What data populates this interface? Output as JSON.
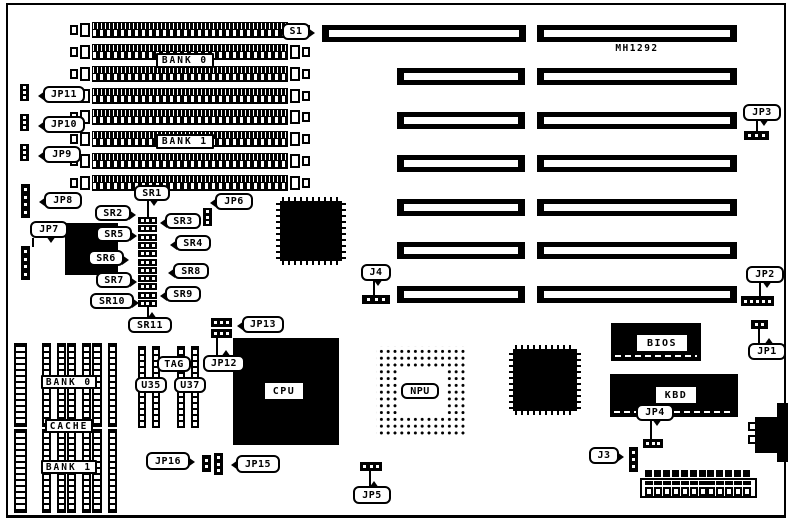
{
  "title": "MH1292",
  "colors": {
    "foreground": "#000000",
    "background": "#ffffff"
  },
  "labels": [
    {
      "id": "s1",
      "text": "S1",
      "x": 282,
      "y": 23,
      "w": 28,
      "h": 17,
      "tail": "r"
    },
    {
      "id": "bank0-top",
      "text": "BANK 0",
      "x": 156,
      "y": 53,
      "w": 58,
      "h": 15,
      "style": "sq"
    },
    {
      "id": "bank1-top",
      "text": "BANK 1",
      "x": 156,
      "y": 134,
      "w": 58,
      "h": 15,
      "style": "sq"
    },
    {
      "id": "jp11",
      "text": "JP11",
      "x": 43,
      "y": 86,
      "w": 42,
      "h": 17,
      "tail": "l"
    },
    {
      "id": "jp10",
      "text": "JP10",
      "x": 43,
      "y": 116,
      "w": 42,
      "h": 17,
      "tail": "l"
    },
    {
      "id": "jp9",
      "text": "JP9",
      "x": 43,
      "y": 146,
      "w": 38,
      "h": 17,
      "tail": "l"
    },
    {
      "id": "jp8",
      "text": "JP8",
      "x": 44,
      "y": 192,
      "w": 38,
      "h": 17,
      "tail": "l"
    },
    {
      "id": "jp7",
      "text": "JP7",
      "x": 30,
      "y": 221,
      "w": 38,
      "h": 17,
      "tail": "d"
    },
    {
      "id": "sr1",
      "text": "SR1",
      "x": 134,
      "y": 185,
      "w": 36,
      "h": 16,
      "tail": "d"
    },
    {
      "id": "sr2",
      "text": "SR2",
      "x": 95,
      "y": 205,
      "w": 36,
      "h": 16,
      "tail": "r"
    },
    {
      "id": "sr3",
      "text": "SR3",
      "x": 165,
      "y": 213,
      "w": 36,
      "h": 16,
      "tail": "l"
    },
    {
      "id": "sr5",
      "text": "SR5",
      "x": 96,
      "y": 226,
      "w": 36,
      "h": 16,
      "tail": "r"
    },
    {
      "id": "sr4",
      "text": "SR4",
      "x": 175,
      "y": 235,
      "w": 36,
      "h": 16,
      "tail": "l"
    },
    {
      "id": "sr6",
      "text": "SR6",
      "x": 88,
      "y": 250,
      "w": 36,
      "h": 16,
      "tail": "r"
    },
    {
      "id": "sr8",
      "text": "SR8",
      "x": 173,
      "y": 263,
      "w": 36,
      "h": 16,
      "tail": "l"
    },
    {
      "id": "sr7",
      "text": "SR7",
      "x": 96,
      "y": 272,
      "w": 36,
      "h": 16,
      "tail": "r"
    },
    {
      "id": "sr9",
      "text": "SR9",
      "x": 165,
      "y": 286,
      "w": 36,
      "h": 16,
      "tail": "l"
    },
    {
      "id": "sr10",
      "text": "SR10",
      "x": 90,
      "y": 293,
      "w": 44,
      "h": 16,
      "tail": "r"
    },
    {
      "id": "sr11",
      "text": "SR11",
      "x": 128,
      "y": 317,
      "w": 44,
      "h": 16,
      "tail": "u"
    },
    {
      "id": "jp6",
      "text": "JP6",
      "x": 215,
      "y": 193,
      "w": 38,
      "h": 17,
      "tail": "l"
    },
    {
      "id": "jp13",
      "text": "JP13",
      "x": 242,
      "y": 316,
      "w": 42,
      "h": 17,
      "tail": "l"
    },
    {
      "id": "jp12",
      "text": "JP12",
      "x": 203,
      "y": 355,
      "w": 42,
      "h": 17,
      "tail": "u"
    },
    {
      "id": "tag",
      "text": "TAG",
      "x": 157,
      "y": 356,
      "w": 34,
      "h": 16
    },
    {
      "id": "u35",
      "text": "U35",
      "x": 135,
      "y": 377,
      "w": 32,
      "h": 16
    },
    {
      "id": "u37",
      "text": "U37",
      "x": 174,
      "y": 377,
      "w": 32,
      "h": 16
    },
    {
      "id": "jp16",
      "text": "JP16",
      "x": 146,
      "y": 452,
      "w": 44,
      "h": 18,
      "tail": "r"
    },
    {
      "id": "jp15",
      "text": "JP15",
      "x": 236,
      "y": 455,
      "w": 44,
      "h": 18,
      "tail": "l"
    },
    {
      "id": "jp5",
      "text": "JP5",
      "x": 353,
      "y": 486,
      "w": 38,
      "h": 18,
      "tail": "u"
    },
    {
      "id": "j4",
      "text": "J4",
      "x": 361,
      "y": 264,
      "w": 30,
      "h": 17,
      "tail": "d"
    },
    {
      "id": "jp3",
      "text": "JP3",
      "x": 743,
      "y": 104,
      "w": 38,
      "h": 17,
      "tail": "d"
    },
    {
      "id": "jp2",
      "text": "JP2",
      "x": 746,
      "y": 266,
      "w": 38,
      "h": 17,
      "tail": "d"
    },
    {
      "id": "jp1",
      "text": "JP1",
      "x": 748,
      "y": 343,
      "w": 38,
      "h": 17,
      "tail": "u"
    },
    {
      "id": "jp4",
      "text": "JP4",
      "x": 636,
      "y": 404,
      "w": 38,
      "h": 17,
      "tail": "d"
    },
    {
      "id": "j3",
      "text": "J3",
      "x": 589,
      "y": 447,
      "w": 30,
      "h": 17,
      "tail": "r"
    },
    {
      "id": "bank0-cache",
      "text": "BANK 0",
      "x": 41,
      "y": 375,
      "w": 56,
      "h": 14,
      "style": "sq"
    },
    {
      "id": "cache",
      "text": "CACHE",
      "x": 45,
      "y": 419,
      "w": 48,
      "h": 14,
      "style": "sq"
    },
    {
      "id": "bank1-cache",
      "text": "BANK 1",
      "x": 41,
      "y": 460,
      "w": 56,
      "h": 14,
      "style": "sq"
    },
    {
      "id": "cpu",
      "text": "CPU",
      "x": 265,
      "y": 383,
      "w": 38,
      "h": 16,
      "style": "plain"
    },
    {
      "id": "npu",
      "text": "NPU",
      "x": 401,
      "y": 383,
      "w": 38,
      "h": 16
    },
    {
      "id": "bios",
      "text": "BIOS",
      "x": 637,
      "y": 335,
      "w": 50,
      "h": 16,
      "style": "plain"
    },
    {
      "id": "kbd",
      "text": "KBD",
      "x": 656,
      "y": 387,
      "w": 40,
      "h": 16,
      "style": "plain"
    },
    {
      "id": "mh1292",
      "text": "MH1292",
      "x": 610,
      "y": 42,
      "w": 54,
      "h": 12,
      "style": "text"
    }
  ],
  "simm_bank_rows_y": [
    22,
    44,
    66,
    88,
    109,
    131,
    153,
    175
  ],
  "isa_slots": [
    {
      "x": 322,
      "y": 25,
      "w": 204
    },
    {
      "x": 537,
      "y": 25,
      "w": 200
    },
    {
      "x": 397,
      "y": 68,
      "w": 128
    },
    {
      "x": 537,
      "y": 68,
      "w": 200
    },
    {
      "x": 397,
      "y": 112,
      "w": 128
    },
    {
      "x": 537,
      "y": 112,
      "w": 200
    },
    {
      "x": 397,
      "y": 155,
      "w": 128
    },
    {
      "x": 537,
      "y": 155,
      "w": 200
    },
    {
      "x": 397,
      "y": 199,
      "w": 128
    },
    {
      "x": 537,
      "y": 199,
      "w": 200
    },
    {
      "x": 397,
      "y": 242,
      "w": 128
    },
    {
      "x": 537,
      "y": 242,
      "w": 200
    },
    {
      "x": 397,
      "y": 286,
      "w": 128
    },
    {
      "x": 537,
      "y": 286,
      "w": 200
    }
  ],
  "chips": [
    {
      "id": "qfp-chipset-1",
      "type": "qfp",
      "x": 276,
      "y": 197,
      "w": 70,
      "h": 68
    },
    {
      "id": "qfp-chipset-2",
      "type": "qfp",
      "x": 509,
      "y": 345,
      "w": 72,
      "h": 70
    },
    {
      "id": "cpu-chip",
      "type": "solid",
      "x": 233,
      "y": 338,
      "w": 106,
      "h": 107
    },
    {
      "id": "plcc-chip",
      "type": "solid",
      "x": 65,
      "y": 223,
      "w": 53,
      "h": 52
    },
    {
      "id": "npu-socket",
      "type": "pga",
      "x": 376,
      "y": 346,
      "w": 90,
      "h": 90,
      "ix": 398,
      "iy": 368,
      "iw": 47,
      "ih": 47
    },
    {
      "id": "bios-chip",
      "type": "chip",
      "x": 611,
      "y": 323,
      "w": 90,
      "h": 38
    },
    {
      "id": "kbd-chip",
      "type": "chip",
      "x": 610,
      "y": 374,
      "w": 128,
      "h": 43
    }
  ],
  "dip_chips": [
    {
      "x": 14,
      "y": 343,
      "w": 13,
      "h": 84,
      "cols": 1
    },
    {
      "x": 42,
      "y": 343,
      "w": 24,
      "h": 84,
      "cols": 2
    },
    {
      "x": 67,
      "y": 343,
      "w": 24,
      "h": 84,
      "cols": 2
    },
    {
      "x": 92,
      "y": 343,
      "w": 25,
      "h": 84,
      "cols": 2
    },
    {
      "x": 14,
      "y": 429,
      "w": 13,
      "h": 84,
      "cols": 1
    },
    {
      "x": 42,
      "y": 429,
      "w": 24,
      "h": 84,
      "cols": 2
    },
    {
      "x": 67,
      "y": 429,
      "w": 24,
      "h": 84,
      "cols": 2
    },
    {
      "x": 92,
      "y": 429,
      "w": 25,
      "h": 84,
      "cols": 2
    },
    {
      "x": 138,
      "y": 346,
      "w": 22,
      "h": 82,
      "cols": 2
    },
    {
      "x": 177,
      "y": 346,
      "w": 22,
      "h": 82,
      "cols": 2
    }
  ],
  "jumpers": [
    {
      "id": "jp11-jumper",
      "x": 20,
      "y": 84,
      "w": 9,
      "h": 17,
      "pins": 3,
      "orient": "v"
    },
    {
      "id": "jp10-jumper",
      "x": 20,
      "y": 114,
      "w": 9,
      "h": 17,
      "pins": 3,
      "orient": "v"
    },
    {
      "id": "jp9-jumper",
      "x": 20,
      "y": 144,
      "w": 9,
      "h": 17,
      "pins": 3,
      "orient": "v"
    },
    {
      "id": "jp8-jumper",
      "x": 21,
      "y": 184,
      "w": 9,
      "h": 34,
      "pins": 4,
      "orient": "v"
    },
    {
      "id": "jp7-jumper",
      "x": 21,
      "y": 246,
      "w": 9,
      "h": 34,
      "pins": 4,
      "orient": "v"
    },
    {
      "id": "jp6-jumper",
      "x": 203,
      "y": 208,
      "w": 9,
      "h": 18,
      "pins": 3,
      "orient": "v"
    },
    {
      "id": "jp13-jumper-a",
      "x": 211,
      "y": 318,
      "w": 21,
      "h": 9,
      "pins": 3,
      "orient": "h"
    },
    {
      "id": "jp13-jumper-b",
      "x": 211,
      "y": 329,
      "w": 21,
      "h": 9,
      "pins": 3,
      "orient": "h"
    },
    {
      "id": "jp16-jumper",
      "x": 202,
      "y": 455,
      "w": 9,
      "h": 17,
      "pins": 2,
      "orient": "v"
    },
    {
      "id": "jp15-jumper",
      "x": 214,
      "y": 453,
      "w": 9,
      "h": 22,
      "pins": 3,
      "orient": "v"
    },
    {
      "id": "j4-jumper",
      "x": 362,
      "y": 295,
      "w": 28,
      "h": 9,
      "pins": 3,
      "orient": "h"
    },
    {
      "id": "jp5-jumper",
      "x": 360,
      "y": 462,
      "w": 22,
      "h": 9,
      "pins": 3,
      "orient": "h"
    },
    {
      "id": "jp3-jumper",
      "x": 744,
      "y": 131,
      "w": 25,
      "h": 9,
      "pins": 3,
      "orient": "h"
    },
    {
      "id": "jp2-jumper",
      "x": 741,
      "y": 296,
      "w": 33,
      "h": 10,
      "pins": 5,
      "orient": "h"
    },
    {
      "id": "jp1-jumper",
      "x": 751,
      "y": 320,
      "w": 17,
      "h": 9,
      "pins": 2,
      "orient": "h"
    },
    {
      "id": "jp4-jumper",
      "x": 643,
      "y": 439,
      "w": 20,
      "h": 9,
      "pins": 3,
      "orient": "h"
    },
    {
      "id": "j3-jumper",
      "x": 629,
      "y": 447,
      "w": 9,
      "h": 25,
      "pins": 3,
      "orient": "v"
    }
  ],
  "sr_jumper_column": {
    "x": 138,
    "y": 217,
    "w": 19,
    "count": 11,
    "block_h": 8.3
  },
  "leader_lines": [
    {
      "x": 756,
      "y": 121,
      "h": 11
    },
    {
      "x": 759,
      "y": 283,
      "h": 14
    },
    {
      "x": 758,
      "y": 328,
      "h": 16
    },
    {
      "x": 373,
      "y": 281,
      "h": 15
    },
    {
      "x": 369,
      "y": 470,
      "h": 17
    },
    {
      "x": 650,
      "y": 421,
      "h": 19
    },
    {
      "x": 147,
      "y": 201,
      "h": 17
    },
    {
      "x": 147,
      "y": 307,
      "h": 11
    },
    {
      "x": 216,
      "y": 338,
      "h": 18
    },
    {
      "x": 32,
      "y": 238,
      "h": 9
    }
  ],
  "power_connector": {
    "x": 640,
    "y": 478,
    "w": 117,
    "h": 20,
    "pin_count": 12
  },
  "keyboard_connector": {
    "bar": {
      "x": 777,
      "y": 403,
      "w": 11,
      "h": 59
    },
    "block": {
      "x": 755,
      "y": 417,
      "w": 24,
      "h": 36
    },
    "notches": [
      {
        "x": 748,
        "y": 422,
        "w": 9,
        "h": 9
      },
      {
        "x": 748,
        "y": 435,
        "w": 9,
        "h": 9
      }
    ]
  }
}
